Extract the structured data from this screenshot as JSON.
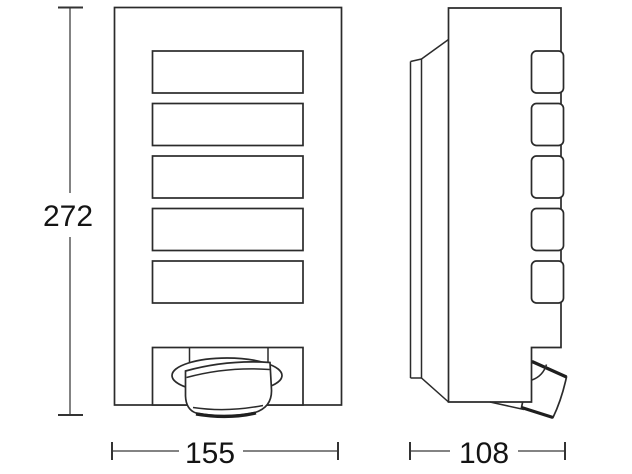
{
  "figure": {
    "type": "technical-dimension-drawing",
    "subject": "wall-light-fixture",
    "dimensions": {
      "overall_height": "272",
      "front_width": "155",
      "side_depth": "108"
    },
    "front_view": {
      "louver_count": 5
    },
    "side_view": {
      "tab_count": 5
    },
    "colors": {
      "line": "#2b2b2b",
      "dimension_line": "#5a5a5a",
      "text": "#141414",
      "background": "#ffffff"
    }
  }
}
